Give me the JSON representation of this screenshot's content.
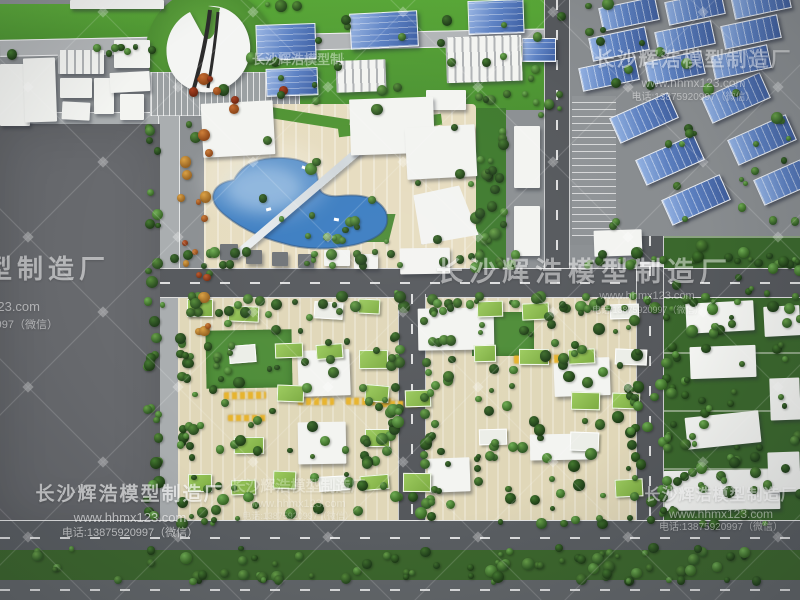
{
  "watermark": {
    "name": "长沙辉浩模型制造厂",
    "website": "www.hhmx123.com",
    "phone": "电话:13875920997（微信）"
  },
  "palette": {
    "pavement": "#8b8f92",
    "asphalt": "#55585c",
    "lawn": "#55a035",
    "empty_lot": "#67696d",
    "plaza_paving": "#e6dcbf",
    "residential_paving": "#e0d7b8",
    "lake_water": "#3a7cc1",
    "blue_glass_building": "#5d82c4",
    "blue_roof_warehouse": "#5c80c0",
    "green_roof_house": "#8cbd4f",
    "white_building": "#f3f4f1",
    "tree_green": "#2c5222",
    "tree_orange": "#b8542a",
    "model_label_yellow": "#e7b32c"
  }
}
